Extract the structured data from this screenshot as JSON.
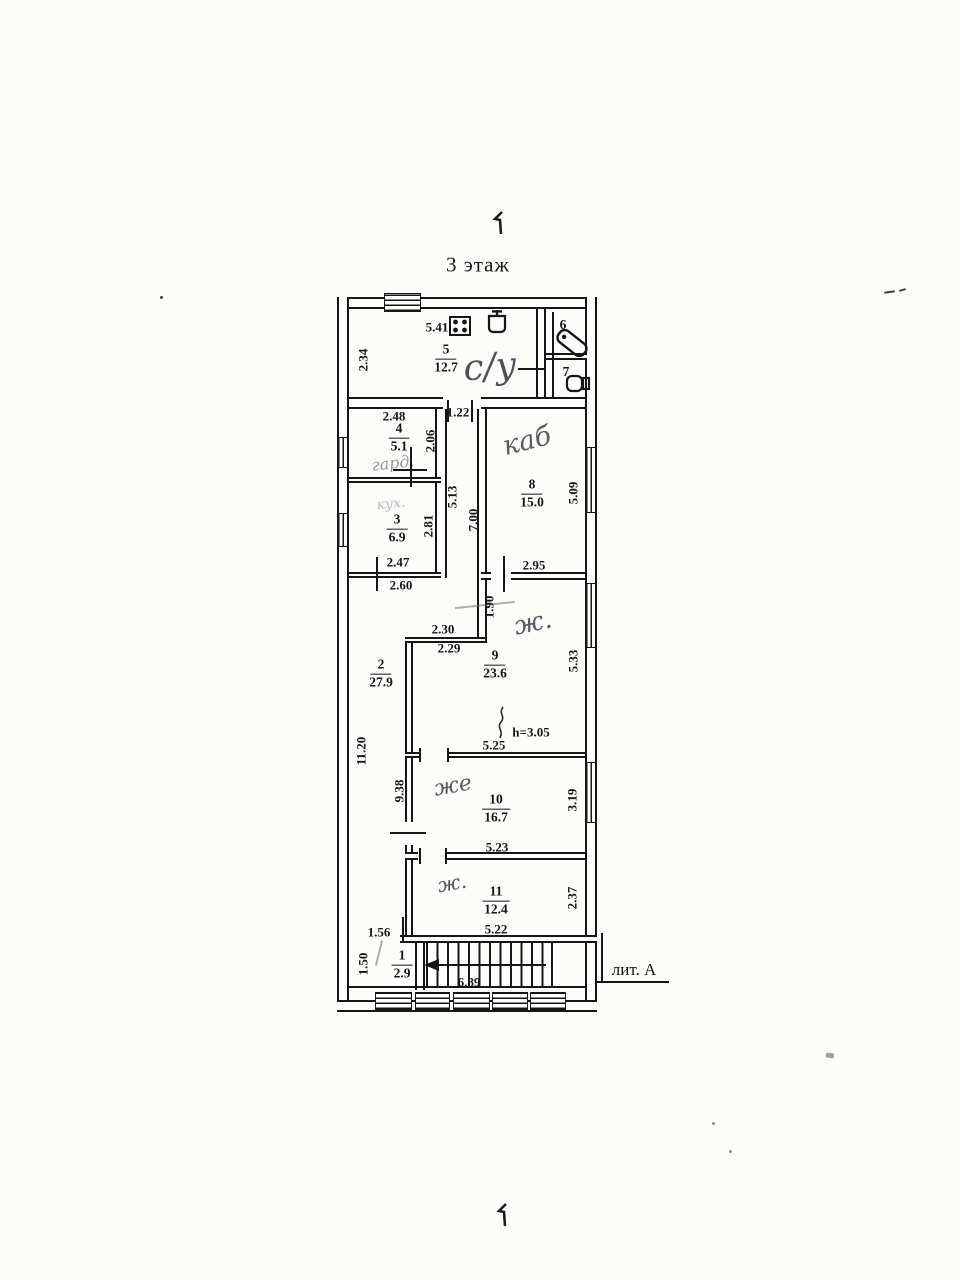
{
  "page": {
    "floor_title": "3 этаж",
    "litera": "лит. А"
  },
  "rooms": [
    {
      "num": "1",
      "area": "2.9",
      "x": 402,
      "y": 965
    },
    {
      "num": "2",
      "area": "27.9",
      "x": 381,
      "y": 674
    },
    {
      "num": "3",
      "area": "6.9",
      "x": 397,
      "y": 529
    },
    {
      "num": "4",
      "area": "5.1",
      "x": 399,
      "y": 438
    },
    {
      "num": "5",
      "area": "12.7",
      "x": 446,
      "y": 359
    },
    {
      "num": "8",
      "area": "15.0",
      "x": 532,
      "y": 494
    },
    {
      "num": "9",
      "area": "23.6",
      "x": 495,
      "y": 665
    },
    {
      "num": "10",
      "area": "16.7",
      "x": 496,
      "y": 809
    },
    {
      "num": "11",
      "area": "12.4",
      "x": 496,
      "y": 901
    }
  ],
  "room_numbers": [
    {
      "t": "6",
      "x": 563,
      "y": 325
    },
    {
      "t": "7",
      "x": 566,
      "y": 372
    }
  ],
  "dims": [
    {
      "t": "5.41",
      "x": 437,
      "y": 327
    },
    {
      "t": "2.34",
      "x": 363,
      "y": 360,
      "r": 1
    },
    {
      "t": "2.48",
      "x": 394,
      "y": 416
    },
    {
      "t": "1.22",
      "x": 458,
      "y": 412
    },
    {
      "t": "2.06",
      "x": 430,
      "y": 441,
      "r": 1
    },
    {
      "t": "5.13",
      "x": 452,
      "y": 497,
      "r": 1
    },
    {
      "t": "7.00",
      "x": 473,
      "y": 520,
      "r": 1
    },
    {
      "t": "2.81",
      "x": 428,
      "y": 526,
      "r": 1
    },
    {
      "t": "2.47",
      "x": 398,
      "y": 562
    },
    {
      "t": "2.60",
      "x": 401,
      "y": 585
    },
    {
      "t": "5.09",
      "x": 573,
      "y": 493,
      "r": 1
    },
    {
      "t": "2.95",
      "x": 534,
      "y": 565
    },
    {
      "t": "1.90",
      "x": 489,
      "y": 607,
      "r": 1
    },
    {
      "t": "2.30",
      "x": 443,
      "y": 629
    },
    {
      "t": "2.29",
      "x": 449,
      "y": 648
    },
    {
      "t": "5.33",
      "x": 573,
      "y": 661,
      "r": 1
    },
    {
      "t": "11.20",
      "x": 361,
      "y": 751,
      "r": 1
    },
    {
      "t": "9.38",
      "x": 399,
      "y": 791,
      "r": 1
    },
    {
      "t": "h=3.05",
      "x": 531,
      "y": 732
    },
    {
      "t": "5.25",
      "x": 494,
      "y": 745
    },
    {
      "t": "3.19",
      "x": 572,
      "y": 800,
      "r": 1
    },
    {
      "t": "5.23",
      "x": 497,
      "y": 847
    },
    {
      "t": "2.37",
      "x": 572,
      "y": 898,
      "r": 1
    },
    {
      "t": "5.22",
      "x": 496,
      "y": 929
    },
    {
      "t": "1.56",
      "x": 379,
      "y": 932
    },
    {
      "t": "1.50",
      "x": 363,
      "y": 964,
      "r": 1
    },
    {
      "t": "6.89",
      "x": 469,
      "y": 982
    }
  ],
  "handwriting": [
    {
      "t": "с/у",
      "x": 490,
      "y": 367,
      "size": 36,
      "rot": -4,
      "op": 0.85
    },
    {
      "t": "гард.",
      "x": 393,
      "y": 463,
      "size": 16,
      "rot": -6,
      "op": 0.5
    },
    {
      "t": "кух.",
      "x": 391,
      "y": 504,
      "size": 14,
      "rot": -6,
      "op": 0.32
    },
    {
      "t": "каб",
      "x": 527,
      "y": 441,
      "size": 27,
      "rot": -14,
      "op": 0.8
    },
    {
      "t": "ж.",
      "x": 533,
      "y": 623,
      "size": 26,
      "rot": -12,
      "op": 0.8
    },
    {
      "t": "же",
      "x": 453,
      "y": 786,
      "size": 22,
      "rot": -10,
      "op": 0.8
    },
    {
      "t": "ж.",
      "x": 452,
      "y": 883,
      "size": 20,
      "rot": -10,
      "op": 0.8
    }
  ],
  "icons": {
    "kitchen_stove": "stove-icon",
    "kitchen_sink": "sink-icon",
    "bathroom": "bathtub-icon",
    "wc": "toilet-icon"
  }
}
